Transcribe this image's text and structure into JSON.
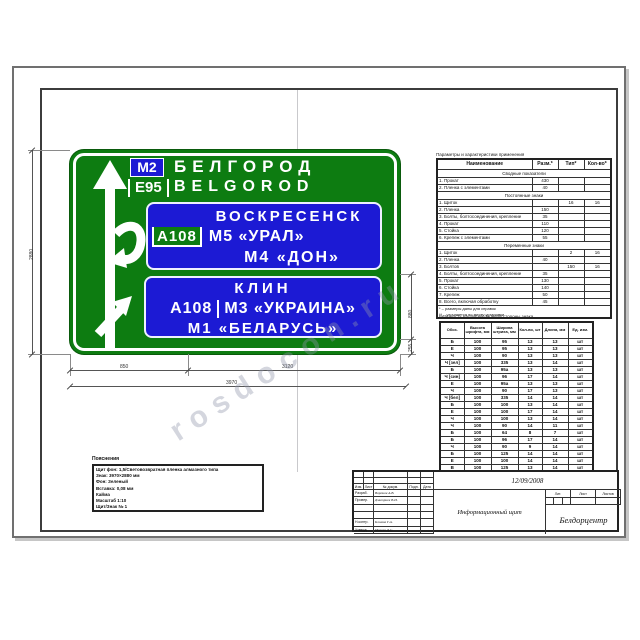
{
  "colors": {
    "sign_green": "#0d7c11",
    "sign_blue": "#1c1ad4",
    "white": "#ffffff",
    "ink": "#222222"
  },
  "sign": {
    "top": {
      "route_chip": "М2",
      "city_ru": "БЕЛГОРОД",
      "euro_route": "Е95",
      "city_en": "BELGOROD"
    },
    "panel1": {
      "line1": "ВОСКРЕСЕНСК",
      "route_chip": "А108",
      "line2": "М5 «УРАЛ»",
      "line3": "М4 «ДОН»"
    },
    "panel2": {
      "line1": "КЛИН",
      "route": "А108",
      "line2": "М3 «УКРАИНА»",
      "line3": "М1 «БЕЛАРУСЬ»"
    }
  },
  "dimensions": {
    "height": "2880",
    "seg1": "850",
    "seg2": "3120",
    "total": "3970",
    "right_top": "880",
    "right_bottom": "255"
  },
  "watermark": "rosdocon.ru",
  "spec_table": {
    "title": "Параметры и характеристики применения",
    "headers": [
      "Наименование",
      "Разм.*",
      "Тип*",
      "Кол-во*"
    ],
    "sections": [
      {
        "band": "Сводные показатели",
        "rows": [
          [
            "1. Прокат",
            "430",
            "",
            ""
          ],
          [
            "2. Пленка с элементами",
            "40",
            "",
            ""
          ]
        ]
      },
      {
        "band": "Постоянные знаки",
        "rows": [
          [
            "1. Щиток",
            "",
            "16",
            "16"
          ],
          [
            "2. Пленка",
            "150",
            "",
            ""
          ],
          [
            "3. Болты, болтосоединения, крепление",
            "35",
            "",
            ""
          ],
          [
            "4. Прокат",
            "110",
            "",
            ""
          ],
          [
            "5. Стойка",
            "120",
            "",
            ""
          ],
          [
            "6. Крепеж с элементами",
            "55",
            "",
            ""
          ]
        ]
      },
      {
        "band": "Переменные знаки",
        "rows": [
          [
            "1. Щиток",
            "",
            "2",
            "16"
          ],
          [
            "2. Пленка",
            "40",
            "",
            ""
          ],
          [
            "3. Болтов",
            "",
            "150",
            "16"
          ],
          [
            "4. Болты, болтосоединения, крепление",
            "35",
            "",
            ""
          ],
          [
            "5. Прокат",
            "130",
            "",
            ""
          ],
          [
            "6. Стойка",
            "140",
            "",
            ""
          ],
          [
            "7. Крепеж",
            "50",
            "",
            ""
          ],
          [
            "8. Всего, включая обработку",
            "45",
            "",
            ""
          ]
        ]
      }
    ],
    "footnotes": [
      "* – размеры даны для справок",
      "** – уточняется по месту установки"
    ]
  },
  "letters_table": {
    "title": "Ведомость надписей лицевой стороны знака",
    "headers": [
      "Обоз.",
      "Высота шрифта, мм",
      "Ширина штриха, мм",
      "Кол-во, шт",
      "Длина, мм",
      "Ед. изм."
    ],
    "rows": [
      [
        "Б",
        "100",
        "95",
        "13",
        "13",
        "шт"
      ],
      [
        "Е",
        "100",
        "95",
        "13",
        "13",
        "шт"
      ],
      [
        "Ч",
        "100",
        "90",
        "13",
        "13",
        "шт"
      ],
      [
        "Ч [зел]",
        "100",
        "335",
        "13",
        "14",
        "шт"
      ],
      [
        "Б",
        "100",
        "95а",
        "13",
        "13",
        "шт"
      ],
      [
        "Ч [син]",
        "100",
        "96",
        "17",
        "14",
        "шт"
      ],
      [
        "Е",
        "100",
        "95а",
        "13",
        "13",
        "шт"
      ],
      [
        "Ч",
        "100",
        "90",
        "17",
        "13",
        "шт"
      ],
      [
        "Ч [бел]",
        "100",
        "335",
        "14",
        "14",
        "шт"
      ],
      [
        "Б",
        "100",
        "100",
        "13",
        "14",
        "шт"
      ],
      [
        "Е",
        "100",
        "100",
        "17",
        "14",
        "шт"
      ],
      [
        "Ч",
        "100",
        "100",
        "13",
        "14",
        "шт"
      ],
      [
        "Ч",
        "100",
        "90",
        "14",
        "11",
        "шт"
      ],
      [
        "Б",
        "100",
        "64",
        "8",
        "7",
        "шт"
      ],
      [
        "Б",
        "100",
        "96",
        "17",
        "14",
        "шт"
      ],
      [
        "Ч",
        "100",
        "90",
        "9",
        "14",
        "шт"
      ],
      [
        "Б",
        "100",
        "125",
        "14",
        "14",
        "шт"
      ],
      [
        "Е",
        "100",
        "100",
        "14",
        "14",
        "шт"
      ],
      [
        "В",
        "100",
        "125",
        "13",
        "14",
        "шт"
      ],
      [
        "Б",
        "100",
        "100",
        "13",
        "13",
        "шт"
      ]
    ]
  },
  "notes": {
    "title": "Пояснения",
    "lines": [
      "Щит фон: 1,5/Световозвратная пленка алмазного типа",
      "Знак: 3970×2880 мм",
      "Фон: Зеленый",
      "Вставка: 0,08 мм",
      "Кайма",
      "Масштаб 1:10",
      "Щит/Знак № 1"
    ]
  },
  "title_block": {
    "date": "12/09/2008",
    "change_header": [
      "Изм.",
      "Лист",
      "№ докум.",
      "Подп.",
      "Дата"
    ],
    "staff_rows": [
      [
        "Разраб.",
        "Воронов А.В."
      ],
      [
        "Провер.",
        "Дмитриев В.И."
      ],
      [
        "",
        ""
      ],
      [
        "",
        ""
      ],
      [
        "Н.контр.",
        "Климов Г.А."
      ],
      [
        "Утверд.",
        "Михеев Д.С."
      ]
    ],
    "doc_label": "Информационный щит",
    "lit_headers": [
      "Лит.",
      "Лист",
      "Листов"
    ],
    "org": "Белдорцентр"
  }
}
